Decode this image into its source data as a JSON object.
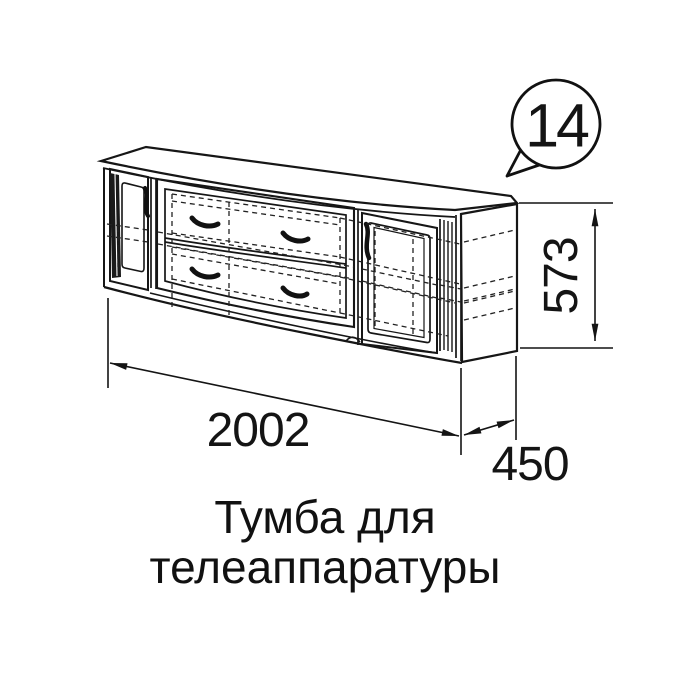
{
  "callout": {
    "number": "14"
  },
  "dimensions": {
    "width": "2002",
    "height": "573",
    "depth": "450"
  },
  "caption": {
    "line1": "Тумба для",
    "line2": "телеаппаратуры"
  },
  "colors": {
    "line": "#161616",
    "background": "#ffffff",
    "handle": "#111111"
  }
}
